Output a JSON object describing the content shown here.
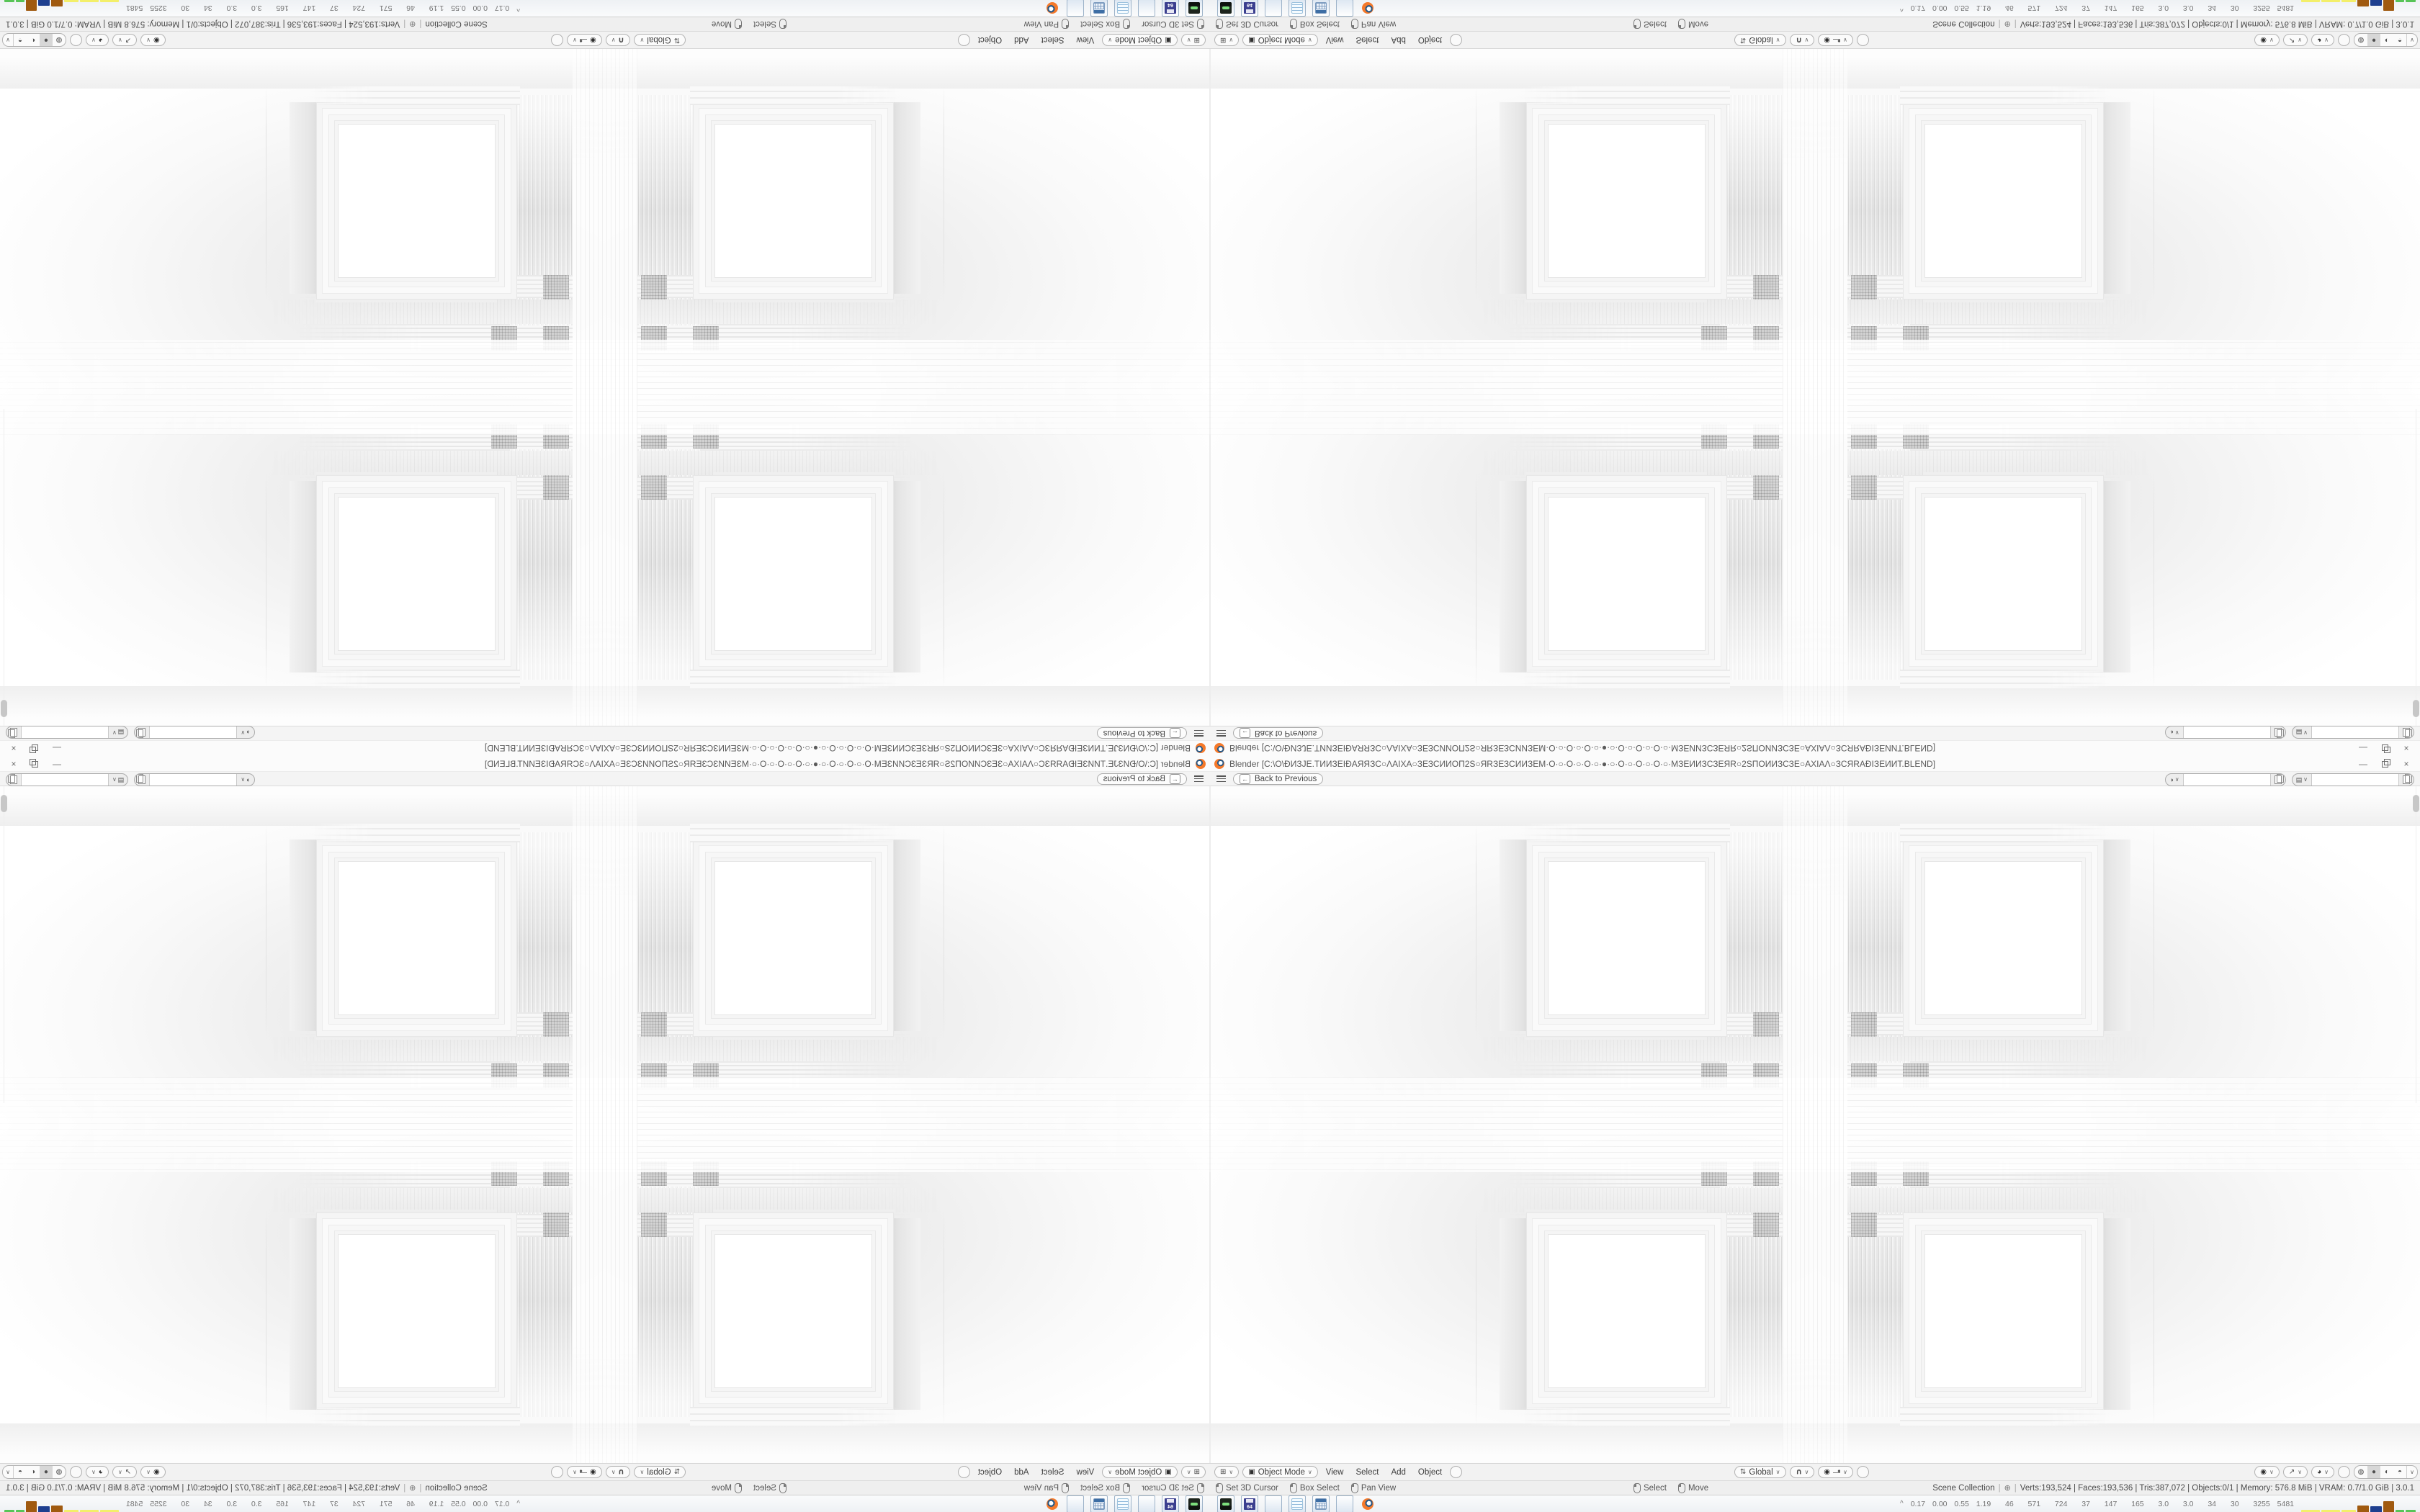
{
  "window": {
    "title": "Blender [C:\\O\\ĐИЗЈЕ.ТИИЗЕІĐАЯЯЗС○ΛАІХА○ЗЕЗСИИОП2S○ЯRЗЕЗСИИЗЕМ·О·○·О·○·О·○·●·○·О·○·О·○·О·○·МЗЕИИЗСЗЕЯR○2SПОИИЗСЗЕ○АХІАΛ○ЗСЯRАĐІЗЕИИТ.BLEND]",
    "minimize_label": "—",
    "restore_label": "❐",
    "close_label": "×"
  },
  "topbar": {
    "back_label": "Back to Previous",
    "back_key_icon": "←"
  },
  "selectors": {
    "scene_value": "",
    "viewlayer_value": ""
  },
  "header": {
    "editor_icon": "⊞",
    "mode_icon": "▣",
    "mode": "Object Mode",
    "menus": [
      "View",
      "Select",
      "Add",
      "Object"
    ],
    "orientation_icon": "⇅",
    "orientation": "Global",
    "snap_icon": "∪",
    "prop_icon": "◉",
    "gizmo_icon": "◉",
    "overlay_icon": "↗",
    "xray_icon": "◕",
    "shading_icons": [
      "◍",
      "●",
      "◐",
      "◓"
    ],
    "chevron": "∨"
  },
  "statusbar": {
    "hints_left": [
      {
        "label": "Set 3D Cursor"
      },
      {
        "label": "Box Select"
      },
      {
        "label": "Pan View"
      }
    ],
    "hints_mid": [
      {
        "label": "Select"
      },
      {
        "label": "Move"
      }
    ],
    "scene": "Scene Collection",
    "plus_icon": "⊕",
    "stats": [
      "Verts:193,524",
      "Faces:193,536",
      "Tris:387,072",
      "Objects:0/1",
      "Memory: 576.8 MiB",
      "VRAM: 0.7/1.0 GiB",
      "3.0.1"
    ]
  },
  "taskbar": {
    "apps": [
      "game",
      "dosbox",
      "firefox",
      "notepad",
      "calculator",
      "firefox",
      "blender"
    ],
    "dosbox_label": "64",
    "tray_arrow": "^",
    "tray_numbers": "0.17 0.00 0.55 1.19  46  571  724  37  147  165  3.0  3.0  34  30  3255 5481",
    "tray_bars": [
      {
        "c": "#f3ef6a",
        "w": 26,
        "h": 3
      },
      {
        "c": "#f3ef6a",
        "w": 26,
        "h": 3
      },
      {
        "c": "#f3ef6a",
        "w": 20,
        "h": 3
      },
      {
        "c": "#a05a10",
        "w": 16,
        "h": 9
      },
      {
        "c": "#1e3f8f",
        "w": 16,
        "h": 8
      },
      {
        "c": "#a05a10",
        "w": 15,
        "h": 15
      },
      {
        "c": "#57c457",
        "w": 12,
        "h": 3
      },
      {
        "c": "#57c457",
        "w": 14,
        "h": 3
      }
    ]
  },
  "colors": {
    "accent_orange": "#f5792a",
    "chrome_bg": "#f2f2f2",
    "titlebar_bg": "#fbfbfb",
    "taskbar_border": "#9db3c9"
  }
}
